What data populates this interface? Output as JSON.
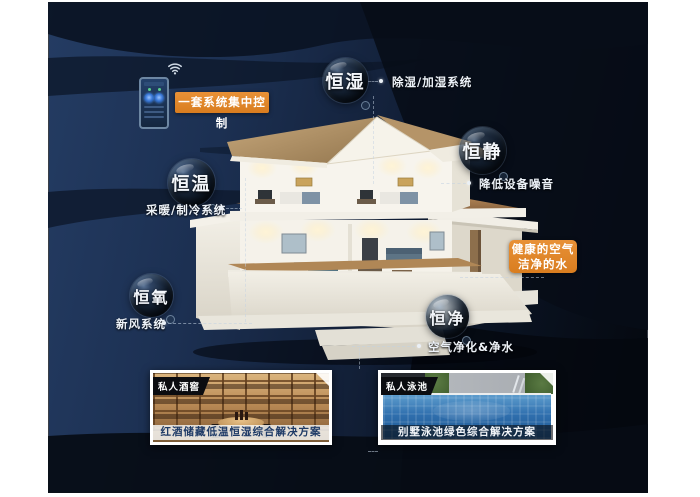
{
  "control": {
    "label": "一套系统集中控制"
  },
  "bubbles": [
    {
      "label": "恒湿",
      "desc": "除湿/加湿系统"
    },
    {
      "label": "恒静",
      "desc": "降低设备噪音"
    },
    {
      "label": "恒温",
      "desc": "采暖/制冷系统"
    },
    {
      "label": "恒氧",
      "desc": "新风系统"
    },
    {
      "label": "恒净",
      "desc": "空气净化&净水"
    }
  ],
  "highlight": {
    "line1": "健康的空气",
    "line2": "洁净的水"
  },
  "photos": [
    {
      "tag": "私人酒窖",
      "caption": "红酒储藏低温恒湿综合解决方案"
    },
    {
      "tag": "私人泳池",
      "caption": "别墅泳池绿色综合解决方案"
    }
  ],
  "colors": {
    "accent_orange": "#e08427",
    "canvas_navy": "#1c3052",
    "canvas_black": "#04070d",
    "caption_blue": "#1e3a66",
    "roof_tan": "#b99a6e"
  }
}
